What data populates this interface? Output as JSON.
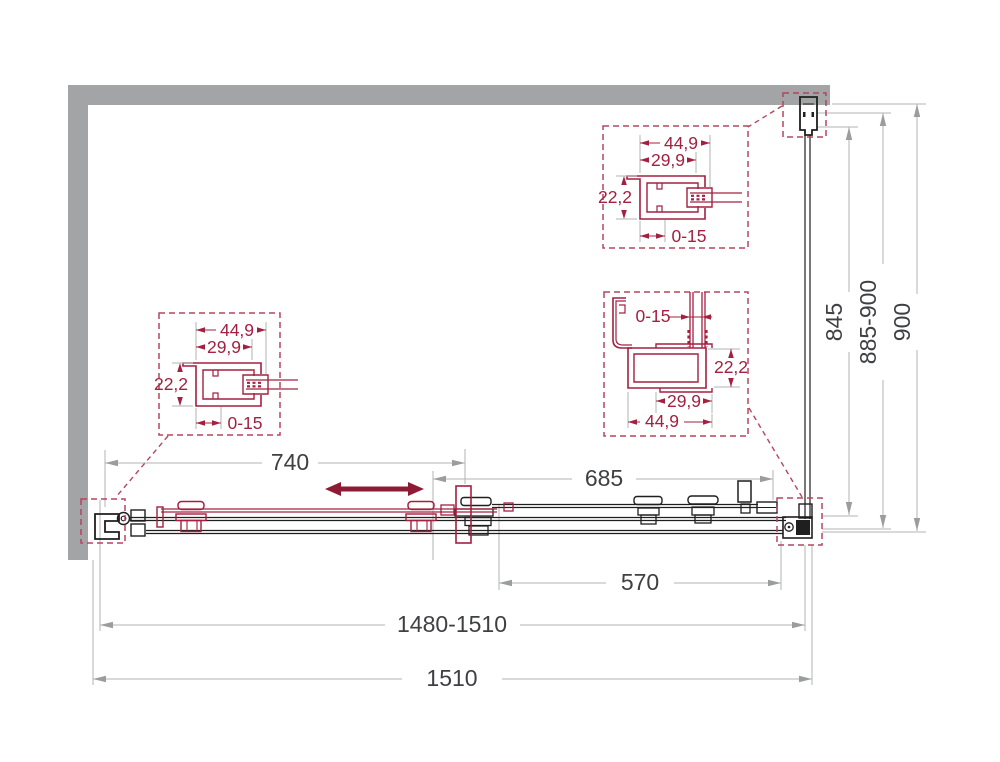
{
  "drawing": {
    "subject": "sliding-shower-door-plan-technical-drawing",
    "colors": {
      "wall_gray": "#a2a4a6",
      "profile_accent": "#a32040",
      "detail_dash": "#b5455f",
      "slide_arrow": "#8e1b34",
      "dimension_line": "#b2b4b6",
      "dimension_text": "#3e4043",
      "drawing_black": "#1f1f1f"
    },
    "main_dimensions": {
      "door_travel": "740",
      "fixed_section": "685",
      "opening": "570",
      "adjustable_width": "1480-1510",
      "total_width": "1510"
    },
    "side_dimensions": {
      "glass_depth": "845",
      "adjustable_depth": "885-900",
      "total_depth": "900"
    },
    "detail_left_profile": {
      "outer_width": "44,9",
      "inner_width": "29,9",
      "depth": "22,2",
      "adjustment": "0-15"
    },
    "detail_top_profile": {
      "outer_width": "44,9",
      "inner_width": "29,9",
      "depth": "22,2",
      "adjustment": "0-15"
    },
    "detail_corner_profile": {
      "adjustment": "0-15",
      "depth": "22,2",
      "inner_width": "29,9",
      "outer_width": "44,9"
    }
  }
}
